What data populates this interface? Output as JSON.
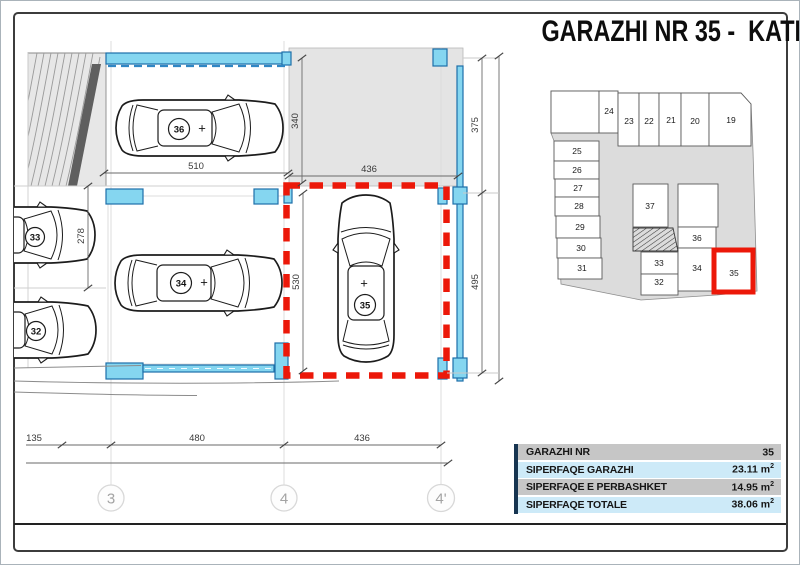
{
  "page": {
    "title": "GARAZHI NR 35 -  KATI -2"
  },
  "plan": {
    "dims": {
      "d510": "510",
      "d340": "340",
      "d436_top": "436",
      "d375": "375",
      "d530": "530",
      "d495": "495",
      "d278": "278",
      "d135": "135",
      "d480": "480",
      "d436_bottom": "436"
    },
    "grid": [
      "3",
      "4",
      "4'"
    ],
    "cars": {
      "c36": "36",
      "c34": "34",
      "c35": "35",
      "c33": "33",
      "c32": "32"
    },
    "plus": "+"
  },
  "keyplan": {
    "units": [
      "24",
      "23",
      "22",
      "21",
      "20",
      "19",
      "25",
      "26",
      "27",
      "28",
      "29",
      "30",
      "31",
      "37",
      "36",
      "33",
      "32",
      "34",
      "35"
    ],
    "highlighted": "35"
  },
  "table": {
    "rows": [
      {
        "label": "GARAZHI NR",
        "value": "35",
        "unit": "",
        "sup": ""
      },
      {
        "label": "SIPERFAQE GARAZHI",
        "value": "23.11",
        "unit": " m",
        "sup": "2"
      },
      {
        "label": "SIPERFAQE E PERBASHKET",
        "value": "14.95",
        "unit": " m",
        "sup": "2"
      },
      {
        "label": "SIPERFAQE TOTALE",
        "value": "38.06",
        "unit": " m",
        "sup": "2"
      }
    ]
  },
  "colors": {
    "highlight_red": "#ec1809",
    "wall_cyan_fill": "#85d6f0",
    "wall_blue_stroke": "#1d6fa9",
    "row_gray": "#c6c6c6",
    "row_blue": "#cdeaf8",
    "table_strip_navy": "#173551",
    "site_gray": "#dcdcdc"
  }
}
